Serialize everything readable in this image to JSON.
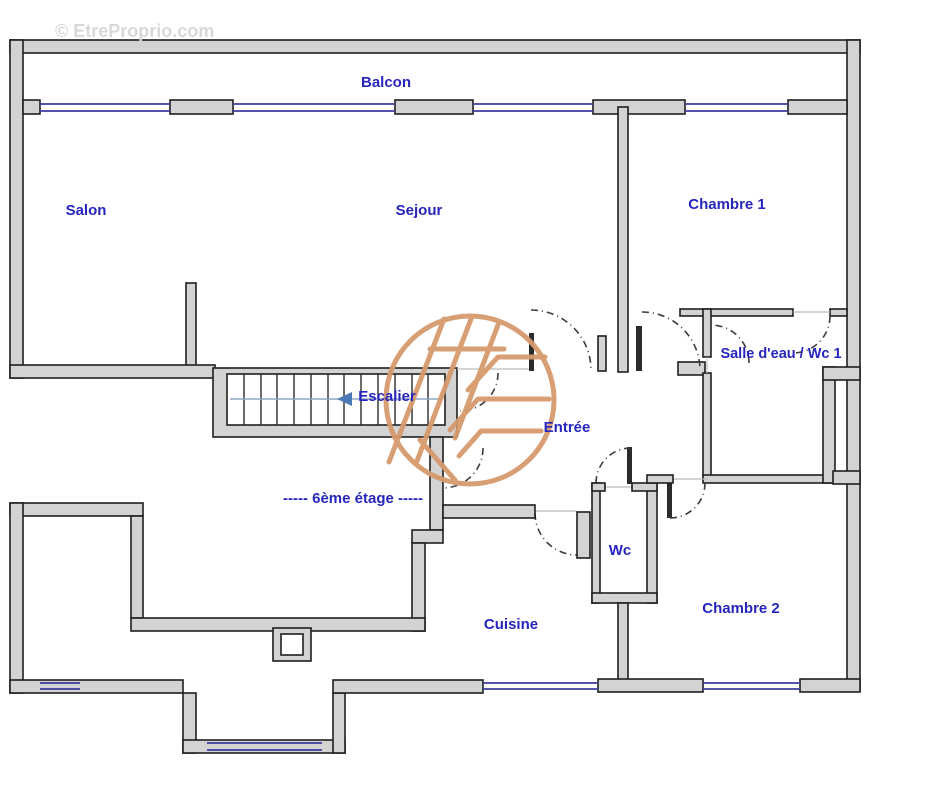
{
  "watermark": {
    "copyright": "© EtreProprio.com"
  },
  "plan": {
    "floor_label": "----- 6ème étage -----",
    "rooms": {
      "balcon": "Balcon",
      "salon": "Salon",
      "sejour": "Sejour",
      "chambre1": "Chambre 1",
      "salle_eau_wc1": "Salle d'eau / Wc 1",
      "escalier": "Escalier",
      "entree": "Entrée",
      "wc": "Wc",
      "cuisine": "Cuisine",
      "chambre2": "Chambre 2"
    },
    "colors": {
      "label_blue": "#2626bd",
      "wall_fill": "#d3d3d3",
      "wall_edge": "#1f1f1f",
      "window_blue": "#3c3c9e",
      "logo_orange": "#d69a6d",
      "watermark_gray": "#d8d8d8",
      "stair_arrow_blue": "#4a7ab5"
    }
  }
}
